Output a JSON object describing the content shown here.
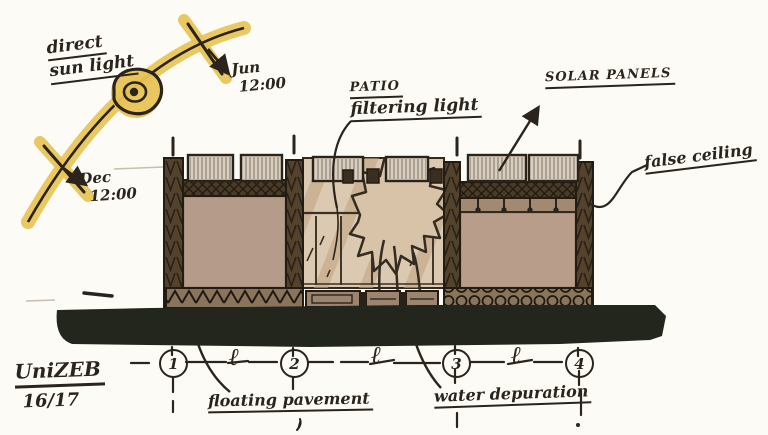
{
  "title_block": {
    "project": "UniZEB",
    "year": "16/17"
  },
  "sun": {
    "label_line1": "direct",
    "label_line2": "sun light",
    "summer_line1": "Jun",
    "summer_line2": "12:00",
    "winter_line1": "Dec",
    "winter_line2": "12:00"
  },
  "labels": {
    "patio_title": "PATIO",
    "patio_sub": "filtering light",
    "solar_panels": "SOLAR PANELS",
    "false_ceiling": "false ceiling",
    "floating_pavement": "floating pavement",
    "water_depuration": "water depuration"
  },
  "grid": {
    "axes": [
      "1",
      "2",
      "3",
      "4"
    ],
    "spans": [
      "ℓ",
      "ℓ",
      "ℓ"
    ]
  },
  "colors": {
    "highlighter_yellow": "#e8c355",
    "ink": "#2b241c",
    "wall_brown": "#54432c",
    "interior_tan": "#b59b89",
    "glass_beige": "#dcc9b1",
    "ground_black": "#22261c"
  }
}
